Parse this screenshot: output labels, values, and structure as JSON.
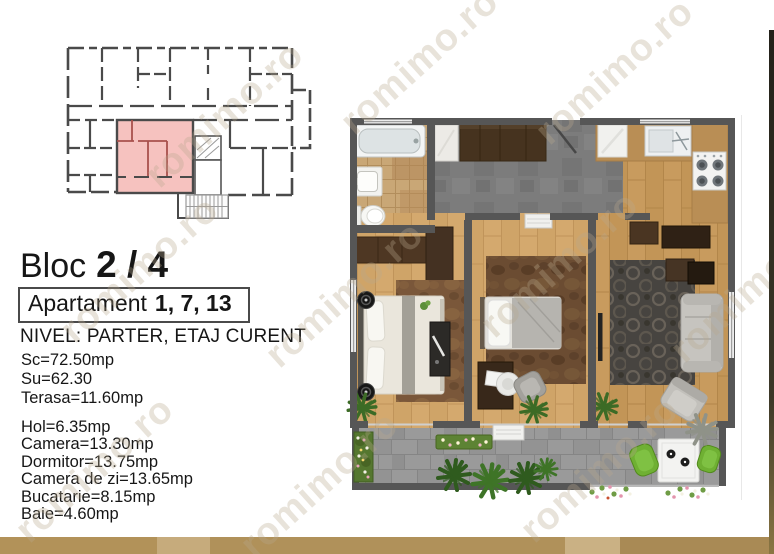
{
  "watermark": {
    "text": "romimo.ro"
  },
  "title": {
    "bloc_label": "Bloc",
    "bloc_value": "2 / 4"
  },
  "apartment": {
    "label": "Apartament",
    "numbers": "1, 7, 13"
  },
  "level": {
    "text": "NIVEL: PARTER, ETAJ CURENT"
  },
  "areas": {
    "primary": [
      "Sc=72.50mp",
      "Su=62.30",
      "Terasa=11.60mp"
    ],
    "rooms": [
      "Hol=6.35mp",
      "Camera=13.30mp",
      "Dormitor=13.75mp",
      "Camera de zi=13.65mp",
      "Bucatarie=8.15mp",
      "Baie=4.60mp"
    ]
  },
  "colors": {
    "highlight_unit_pink": "#f6c2bf",
    "highlight_unit_wall": "#a8514d",
    "schematic_wall": "#4a4a4a",
    "plan_wall": "#565656",
    "watermark": "#b9a98e",
    "gold_bar": [
      "#b29259",
      "#c6ab7c",
      "#b0915a",
      "#cab184",
      "#a98a55"
    ]
  }
}
